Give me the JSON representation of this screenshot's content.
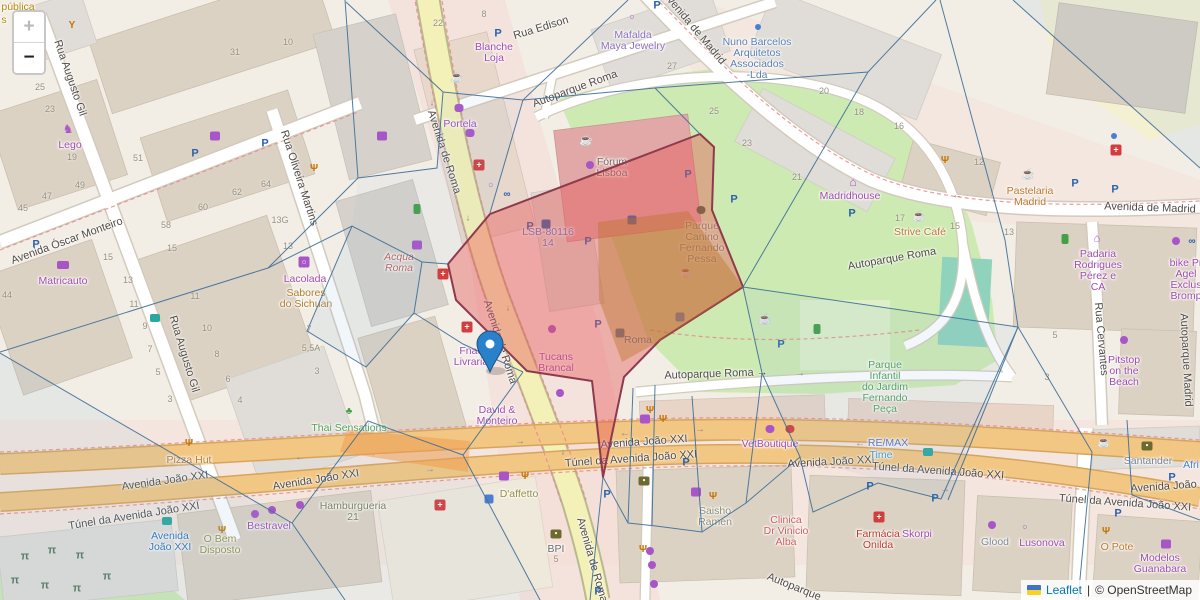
{
  "attribution": {
    "leaflet": "Leaflet",
    "separator": "|",
    "osm": "© OpenStreetMap"
  },
  "zoom_control": {
    "zoom_in": "+",
    "zoom_out": "−"
  },
  "marker": {
    "x": 490,
    "y": 372,
    "color": "#2a81cb"
  },
  "colors": {
    "overlay_red_fill": "rgba(229,85,85,0.42)",
    "overlay_red_stroke": "#8e3a4d",
    "voronoi_blue": "#3d6e99",
    "road_primary_orange": "#f2c783",
    "road_yellow": "#f3f0b8",
    "park_green": "#cdeab2",
    "marker_blue": "#2a81cb",
    "attribution_link_blue": "#0078A8",
    "shop_purple": "#a24ab0"
  },
  "streets": [
    {
      "t": "Rua Augusto Gil",
      "x": 70,
      "y": 78,
      "r": 71
    },
    {
      "t": "Rua Augusto Gil",
      "x": 184,
      "y": 354,
      "r": 73
    },
    {
      "t": "Avenida Óscar Monteiro",
      "x": 67,
      "y": 241,
      "r": -20
    },
    {
      "t": "Rua Oliveira Martins",
      "x": 299,
      "y": 178,
      "r": 72
    },
    {
      "t": "Rua Edison",
      "x": 541,
      "y": 28,
      "r": -17
    },
    {
      "t": "Autoparque Roma",
      "x": 575,
      "y": 89,
      "r": -20
    },
    {
      "t": "Autoparque Roma",
      "x": 892,
      "y": 259,
      "r": -10
    },
    {
      "t": "Autoparque Roma →",
      "x": 716,
      "y": 374,
      "r": -2
    },
    {
      "t": "Avenida de Madrid",
      "x": 694,
      "y": 28,
      "r": 50
    },
    {
      "t": "Avenida de Madrid",
      "x": 1150,
      "y": 208,
      "r": 2
    },
    {
      "t": "Avenida de Roma",
      "x": 444,
      "y": 152,
      "r": 72
    },
    {
      "t": "Avenida de Roma",
      "x": 500,
      "y": 342,
      "r": 72
    },
    {
      "t": "Avenida de Roma",
      "x": 592,
      "y": 560,
      "r": 74
    },
    {
      "t": "Avenida João XXI",
      "x": 165,
      "y": 481,
      "r": -8
    },
    {
      "t": "Túnel da Avenida João XXI",
      "x": 134,
      "y": 516,
      "r": -9
    },
    {
      "t": "Avenida João XXI",
      "x": 316,
      "y": 480,
      "r": -9
    },
    {
      "t": "Avenida João XXI",
      "x": 644,
      "y": 442,
      "r": -4
    },
    {
      "t": "Túnel da Avenida João XXI",
      "x": 631,
      "y": 459,
      "r": -4
    },
    {
      "t": "Avenida João XXI",
      "x": 831,
      "y": 462,
      "r": -3
    },
    {
      "t": "Túnel da Avenida João XXI",
      "x": 938,
      "y": 471,
      "r": 4
    },
    {
      "t": "Túnel da Avenida João XXI",
      "x": 1125,
      "y": 503,
      "r": 4
    },
    {
      "t": "Avenida João XXI",
      "x": 1174,
      "y": 486,
      "r": -4
    },
    {
      "t": "Rua Cervantes",
      "x": 1101,
      "y": 339,
      "r": 85
    },
    {
      "t": "Autoparque Madrid",
      "x": 1186,
      "y": 360,
      "r": 87
    },
    {
      "t": "Autoparque",
      "x": 794,
      "y": 587,
      "r": 22
    }
  ],
  "pois": [
    {
      "l": [
        "pública"
      ],
      "x": 18,
      "y": 8,
      "c": "#b8860b"
    },
    {
      "l": [
        "s"
      ],
      "x": 4,
      "y": 21,
      "c": "#b8860b"
    },
    {
      "l": [
        "Matricauto"
      ],
      "x": 63,
      "y": 282,
      "c": "#a24ab0"
    },
    {
      "l": [
        "Lego"
      ],
      "x": 70,
      "y": 146,
      "c": "#a24ab0"
    },
    {
      "l": [
        "Lacolada"
      ],
      "x": 305,
      "y": 280,
      "c": "#a24ab0"
    },
    {
      "l": [
        "Sabores",
        "do Sichuan"
      ],
      "x": 306,
      "y": 294,
      "c": "#b07d2b"
    },
    {
      "l": [
        "Blanche",
        "Loja"
      ],
      "x": 494,
      "y": 48,
      "c": "#a24ab0"
    },
    {
      "l": [
        "Mafalda",
        "Maya Jewelry"
      ],
      "x": 633,
      "y": 36,
      "c": "#8d6fc0"
    },
    {
      "l": [
        "Portela"
      ],
      "x": 460,
      "y": 125,
      "c": "#a24ab0"
    },
    {
      "l": [
        "Fnac",
        "Livraria"
      ],
      "x": 471,
      "y": 352,
      "c": "#a24ab0"
    },
    {
      "l": [
        "David &",
        "Monteiro"
      ],
      "x": 497,
      "y": 411,
      "c": "#a24ab0"
    },
    {
      "l": [
        "Tucans",
        "Brancal"
      ],
      "x": 556,
      "y": 358,
      "c": "#a24ab0"
    },
    {
      "l": [
        "Bestravel"
      ],
      "x": 269,
      "y": 527,
      "c": "#a24ab0"
    },
    {
      "l": [
        "VetBoutique"
      ],
      "x": 770,
      "y": 445,
      "c": "#a24ab0"
    },
    {
      "l": [
        "Skorpi"
      ],
      "x": 917,
      "y": 535,
      "c": "#a24ab0"
    },
    {
      "l": [
        "Lusonova"
      ],
      "x": 1042,
      "y": 544,
      "c": "#a24ab0"
    },
    {
      "l": [
        "Modelos",
        "Guanabara"
      ],
      "x": 1160,
      "y": 559,
      "c": "#a24ab0"
    },
    {
      "l": [
        "Padaria",
        "Rodrigues",
        "Pérez e",
        "CA"
      ],
      "x": 1098,
      "y": 255,
      "c": "#a24ab0"
    },
    {
      "l": [
        "bike Pr",
        "Agel",
        "Exclus",
        "Bromp"
      ],
      "x": 1186,
      "y": 264,
      "c": "#a24ab0"
    },
    {
      "l": [
        "Pitstop",
        "on the",
        "Beach"
      ],
      "x": 1124,
      "y": 361,
      "c": "#a24ab0"
    },
    {
      "l": [
        "Madridhouse"
      ],
      "x": 850,
      "y": 197,
      "c": "#a24ab0"
    },
    {
      "l": [
        "Hamburgueria",
        "21"
      ],
      "x": 353,
      "y": 507,
      "c": "#7f8150"
    },
    {
      "l": [
        "Thai Sensations"
      ],
      "x": 349,
      "y": 429,
      "c": "#55a055"
    },
    {
      "l": [
        "Pizza Hut"
      ],
      "x": 189,
      "y": 461,
      "c": "#c0762c"
    },
    {
      "l": [
        "O Bem",
        "Disposto"
      ],
      "x": 220,
      "y": 540,
      "c": "#968e3e"
    },
    {
      "l": [
        "D'affetto"
      ],
      "x": 519,
      "y": 495,
      "c": "#968e3e"
    },
    {
      "l": [
        "Saisho",
        "Ramen"
      ],
      "x": 715,
      "y": 512,
      "c": "#8d8d74"
    },
    {
      "l": [
        "Clinica",
        "Dr Vinicio",
        "Alba"
      ],
      "x": 786,
      "y": 521,
      "c": "#d05c5c"
    },
    {
      "l": [
        "Farmácia",
        "Onilda"
      ],
      "x": 878,
      "y": 535,
      "c": "#c0392b"
    },
    {
      "l": [
        "Glood"
      ],
      "x": 995,
      "y": 543,
      "c": "#7d8a99"
    },
    {
      "l": [
        "O Pote"
      ],
      "x": 1117,
      "y": 548,
      "c": "#c0762c"
    },
    {
      "l": [
        "Santander"
      ],
      "x": 1148,
      "y": 462,
      "c": "#77828e"
    },
    {
      "l": [
        "Afri"
      ],
      "x": 1191,
      "y": 466,
      "c": "#4a7fd4"
    },
    {
      "l": [
        "RE/MAX"
      ],
      "x": 888,
      "y": 444,
      "c": "#5a6fc0"
    },
    {
      "l": [
        "Time"
      ],
      "x": 881,
      "y": 456,
      "c": "#3f9bd8"
    },
    {
      "l": [
        "Strive Café"
      ],
      "x": 920,
      "y": 233,
      "c": "#c0762c"
    },
    {
      "l": [
        "Pastelaria",
        "Madrid"
      ],
      "x": 1030,
      "y": 192,
      "c": "#c0762c"
    },
    {
      "l": [
        "Nuno Barcelos",
        "Arquitetos",
        "Associados",
        "-Lda"
      ],
      "x": 757,
      "y": 43,
      "c": "#5b7fb5"
    },
    {
      "l": [
        "Parque",
        "Canino",
        "Fernando",
        "Pessa"
      ],
      "x": 702,
      "y": 227,
      "c": "#55a055"
    },
    {
      "l": [
        "Parque",
        "Infantil",
        "do Jardim",
        "Fernando",
        "Peça"
      ],
      "x": 885,
      "y": 366,
      "c": "#55a055"
    },
    {
      "l": [
        "Roma"
      ],
      "x": 638,
      "y": 341,
      "c": "#2f6fba"
    },
    {
      "l": [
        "LSB-80116",
        "14"
      ],
      "x": 548,
      "y": 233,
      "c": "#4a7fd4"
    },
    {
      "l": [
        "Acqua",
        "Roma"
      ],
      "x": 399,
      "y": 258,
      "c": "#bf5a50",
      "i": 1
    },
    {
      "l": [
        "Fórum",
        "Lisboa"
      ],
      "x": 612,
      "y": 163,
      "c": "#73655a"
    },
    {
      "l": [
        "Avenida",
        "João XXI"
      ],
      "x": 170,
      "y": 537,
      "c": "#2f6fba"
    },
    {
      "l": [
        "BPI"
      ],
      "x": 556,
      "y": 550,
      "c": "#6b6b6b"
    }
  ],
  "housenumbers": [
    [
      "25",
      40,
      87
    ],
    [
      "23",
      50,
      109
    ],
    [
      "19",
      72,
      157
    ],
    [
      "49",
      80,
      185
    ],
    [
      "47",
      47,
      196
    ],
    [
      "51",
      138,
      158
    ],
    [
      "31",
      235,
      52
    ],
    [
      "10",
      288,
      42
    ],
    [
      "64",
      266,
      184
    ],
    [
      "62",
      237,
      192
    ],
    [
      "45",
      23,
      208
    ],
    [
      "44",
      7,
      295
    ],
    [
      "15",
      108,
      257
    ],
    [
      "13",
      128,
      280
    ],
    [
      "11",
      134,
      304
    ],
    [
      "9",
      145,
      326
    ],
    [
      "7",
      150,
      349
    ],
    [
      "5",
      158,
      372
    ],
    [
      "3",
      170,
      399
    ],
    [
      "58",
      166,
      225
    ],
    [
      "60",
      203,
      207
    ],
    [
      "15",
      172,
      248
    ],
    [
      "11",
      195,
      296
    ],
    [
      "10",
      207,
      328
    ],
    [
      "8",
      217,
      354
    ],
    [
      "6",
      228,
      379
    ],
    [
      "4",
      240,
      400
    ],
    [
      "13G",
      280,
      220
    ],
    [
      "13",
      288,
      246
    ],
    [
      "7",
      309,
      329
    ],
    [
      "5,5A",
      311,
      348
    ],
    [
      "3",
      317,
      371
    ],
    [
      "22",
      438,
      23
    ],
    [
      "8",
      484,
      14
    ],
    [
      "27",
      672,
      66
    ],
    [
      "25",
      714,
      111
    ],
    [
      "20",
      824,
      91
    ],
    [
      "18",
      859,
      112
    ],
    [
      "16",
      899,
      126
    ],
    [
      "12",
      979,
      162
    ],
    [
      "23",
      747,
      143
    ],
    [
      "21",
      797,
      177
    ],
    [
      "17",
      900,
      218
    ],
    [
      "15",
      955,
      226
    ],
    [
      "13",
      1009,
      232
    ],
    [
      "5",
      1055,
      335
    ],
    [
      "3",
      1047,
      377
    ],
    [
      "5",
      556,
      559
    ]
  ],
  "icon_types": {
    "parking": {
      "glyph": "P",
      "color": "#2a62ac",
      "size": 11,
      "weight": "bold"
    },
    "cafe": {
      "glyph": "☕",
      "color": "#9c7136",
      "size": 11
    },
    "restaurant": {
      "glyph": "Ψ",
      "color": "#c77400",
      "size": 10,
      "weight": "bold"
    },
    "goblet": {
      "glyph": "Y",
      "color": "#c77400",
      "size": 10,
      "weight": "bold"
    },
    "pharmacy": {
      "glyph": "+",
      "color": "#ffffff",
      "bg": "#d43d3d",
      "size": 9,
      "w": 11,
      "h": 11,
      "rad": 2,
      "weight": "bold"
    },
    "clothes": {
      "bg": "#a855c8",
      "w": 10,
      "h": 9,
      "rad": 2
    },
    "cart": {
      "bg": "#a855c8",
      "w": 10,
      "h": 9,
      "rad": 2
    },
    "dot-purple": {
      "bg": "#a855c8",
      "w": 8,
      "h": 8,
      "rad": 4
    },
    "washing": {
      "glyph": "○",
      "color": "#ffffff",
      "bg": "#a855c8",
      "w": 11,
      "h": 11,
      "rad": 2,
      "size": 8
    },
    "horse": {
      "glyph": "♞",
      "color": "#a855c8",
      "size": 12
    },
    "car-shop": {
      "bg": "#a855c8",
      "w": 12,
      "h": 8,
      "rad": 2
    },
    "house-shop": {
      "glyph": "⌂",
      "color": "#a855c8",
      "size": 12,
      "weight": "bold"
    },
    "factory": {
      "glyph": "⌂",
      "color": "#a855c8",
      "size": 11,
      "weight": "bold"
    },
    "cupcake": {
      "bg": "#a855c8",
      "w": 9,
      "h": 8,
      "rad": 3
    },
    "ring": {
      "glyph": "○",
      "color": "#a855c8",
      "size": 9,
      "weight": "bold"
    },
    "dot-blue": {
      "bg": "#4a7fd4",
      "w": 6,
      "h": 6,
      "rad": 3
    },
    "bike": {
      "glyph": "∞",
      "color": "#2a62ac",
      "size": 10,
      "weight": "bold"
    },
    "bus": {
      "bg": "#2aa7a0",
      "w": 10,
      "h": 8,
      "rad": 2
    },
    "train": {
      "bg": "#2f6fba",
      "w": 9,
      "h": 9,
      "rad": 2
    },
    "runner": {
      "bg": "#43a047",
      "w": 7,
      "h": 10,
      "rad": 2
    },
    "leaf": {
      "glyph": "♣",
      "color": "#43a047",
      "size": 10
    },
    "paw-green": {
      "bg": "#3e6b3e",
      "w": 9,
      "h": 8,
      "rad": 4
    },
    "paw-purple": {
      "bg": "#a855c8",
      "w": 9,
      "h": 8,
      "rad": 4
    },
    "paw-red": {
      "bg": "#d43d3d",
      "w": 9,
      "h": 8,
      "rad": 4
    },
    "wheelchair": {
      "bg": "#4a7fd4",
      "w": 9,
      "h": 9,
      "rad": 2
    },
    "picnic": {
      "glyph": "π",
      "color": "#55775a",
      "size": 11,
      "weight": "bold"
    },
    "atm": {
      "glyph": "●",
      "color": "#ffffff",
      "bg": "#6e6a2f",
      "w": 11,
      "h": 9,
      "rad": 2,
      "size": 5
    },
    "ev": {
      "bg": "#2a62ac",
      "w": 9,
      "h": 9,
      "rad": 2
    },
    "arrow-left": {
      "glyph": "←",
      "color": "#8a8a8a",
      "size": 10
    },
    "arrow-right": {
      "glyph": "→",
      "color": "#8a8a8a",
      "size": 10
    },
    "arrow-down": {
      "glyph": "↓",
      "color": "#8a8a8a",
      "size": 9
    }
  },
  "icons": [
    [
      "parking",
      195,
      154
    ],
    [
      "parking",
      265,
      144
    ],
    [
      "parking",
      36,
      245
    ],
    [
      "parking",
      498,
      34
    ],
    [
      "parking",
      657,
      6
    ],
    [
      "parking",
      530,
      227
    ],
    [
      "parking",
      588,
      242
    ],
    [
      "parking",
      688,
      175
    ],
    [
      "parking",
      734,
      200
    ],
    [
      "parking",
      852,
      214
    ],
    [
      "parking",
      781,
      345
    ],
    [
      "parking",
      598,
      325
    ],
    [
      "parking",
      607,
      495
    ],
    [
      "parking",
      686,
      463
    ],
    [
      "parking",
      870,
      487
    ],
    [
      "parking",
      935,
      499
    ],
    [
      "parking",
      1075,
      184
    ],
    [
      "parking",
      1115,
      190
    ],
    [
      "parking",
      1118,
      514
    ],
    [
      "parking",
      1172,
      478
    ],
    [
      "parking",
      598,
      592
    ],
    [
      "cafe",
      457,
      78
    ],
    [
      "cafe",
      586,
      141
    ],
    [
      "cafe",
      686,
      273
    ],
    [
      "cafe",
      765,
      320
    ],
    [
      "cafe",
      919,
      217
    ],
    [
      "cafe",
      1028,
      175
    ],
    [
      "cafe",
      1104,
      443
    ],
    [
      "restaurant",
      314,
      169
    ],
    [
      "restaurant",
      189,
      444
    ],
    [
      "restaurant",
      222,
      531
    ],
    [
      "restaurant",
      525,
      477
    ],
    [
      "restaurant",
      663,
      420
    ],
    [
      "restaurant",
      713,
      497
    ],
    [
      "restaurant",
      945,
      161
    ],
    [
      "restaurant",
      1106,
      532
    ],
    [
      "restaurant",
      650,
      411
    ],
    [
      "restaurant",
      643,
      550
    ],
    [
      "goblet",
      72,
      26
    ],
    [
      "pharmacy",
      479,
      165
    ],
    [
      "pharmacy",
      443,
      274
    ],
    [
      "pharmacy",
      467,
      327
    ],
    [
      "pharmacy",
      440,
      505
    ],
    [
      "pharmacy",
      879,
      517
    ],
    [
      "pharmacy",
      1116,
      150
    ],
    [
      "clothes",
      382,
      136
    ],
    [
      "clothes",
      696,
      492
    ],
    [
      "clothes",
      1166,
      544
    ],
    [
      "clothes",
      504,
      476
    ],
    [
      "cart",
      417,
      245
    ],
    [
      "cart",
      215,
      136
    ],
    [
      "cart",
      645,
      419
    ],
    [
      "washing",
      304,
      262
    ],
    [
      "horse",
      68,
      129
    ],
    [
      "car-shop",
      63,
      265
    ],
    [
      "house-shop",
      853,
      182
    ],
    [
      "factory",
      1097,
      239
    ],
    [
      "cupcake",
      459,
      108
    ],
    [
      "cupcake",
      470,
      133
    ],
    [
      "ring",
      491,
      185
    ],
    [
      "ring",
      632,
      17
    ],
    [
      "ring",
      1025,
      527
    ],
    [
      "dot-purple",
      1124,
      340
    ],
    [
      "dot-purple",
      590,
      165
    ],
    [
      "dot-purple",
      560,
      393
    ],
    [
      "dot-purple",
      552,
      329
    ],
    [
      "dot-purple",
      652,
      565
    ],
    [
      "dot-purple",
      654,
      584
    ],
    [
      "dot-purple",
      650,
      551
    ],
    [
      "dot-purple",
      300,
      505
    ],
    [
      "dot-purple",
      272,
      510
    ],
    [
      "dot-purple",
      255,
      514
    ],
    [
      "dot-purple",
      992,
      525
    ],
    [
      "dot-purple",
      1176,
      241
    ],
    [
      "dot-blue",
      758,
      27
    ],
    [
      "dot-blue",
      1114,
      136
    ],
    [
      "bike",
      507,
      195
    ],
    [
      "bike",
      1192,
      242
    ],
    [
      "bus",
      167,
      521
    ],
    [
      "bus",
      155,
      318
    ],
    [
      "bus",
      928,
      452
    ],
    [
      "train",
      620,
      333
    ],
    [
      "runner",
      1065,
      239
    ],
    [
      "runner",
      817,
      329
    ],
    [
      "runner",
      417,
      209
    ],
    [
      "leaf",
      349,
      412
    ],
    [
      "paw-green",
      701,
      210
    ],
    [
      "paw-purple",
      770,
      429
    ],
    [
      "paw-red",
      790,
      429
    ],
    [
      "wheelchair",
      489,
      499
    ],
    [
      "wheelchair",
      680,
      317
    ],
    [
      "picnic",
      25,
      557
    ],
    [
      "picnic",
      52,
      551
    ],
    [
      "picnic",
      80,
      556
    ],
    [
      "picnic",
      15,
      581
    ],
    [
      "picnic",
      45,
      586
    ],
    [
      "picnic",
      77,
      589
    ],
    [
      "picnic",
      107,
      577
    ],
    [
      "atm",
      556,
      534
    ],
    [
      "atm",
      1147,
      446
    ],
    [
      "atm",
      644,
      481
    ],
    [
      "ev",
      546,
      224
    ],
    [
      "ev",
      632,
      220
    ],
    [
      "arrow-left",
      300,
      458
    ],
    [
      "arrow-left",
      860,
      444
    ],
    [
      "arrow-left",
      145,
      487
    ],
    [
      "arrow-left",
      625,
      434
    ],
    [
      "arrow-left",
      957,
      196
    ],
    [
      "arrow-right",
      520,
      442
    ],
    [
      "arrow-right",
      700,
      430
    ],
    [
      "arrow-right",
      945,
      490
    ],
    [
      "arrow-right",
      430,
      470
    ],
    [
      "arrow-right",
      800,
      374
    ],
    [
      "arrow-down",
      432,
      103
    ],
    [
      "arrow-down",
      468,
      218
    ],
    [
      "arrow-down",
      508,
      308
    ],
    [
      "arrow-down",
      563,
      452
    ],
    [
      "arrow-down",
      585,
      528
    ]
  ]
}
